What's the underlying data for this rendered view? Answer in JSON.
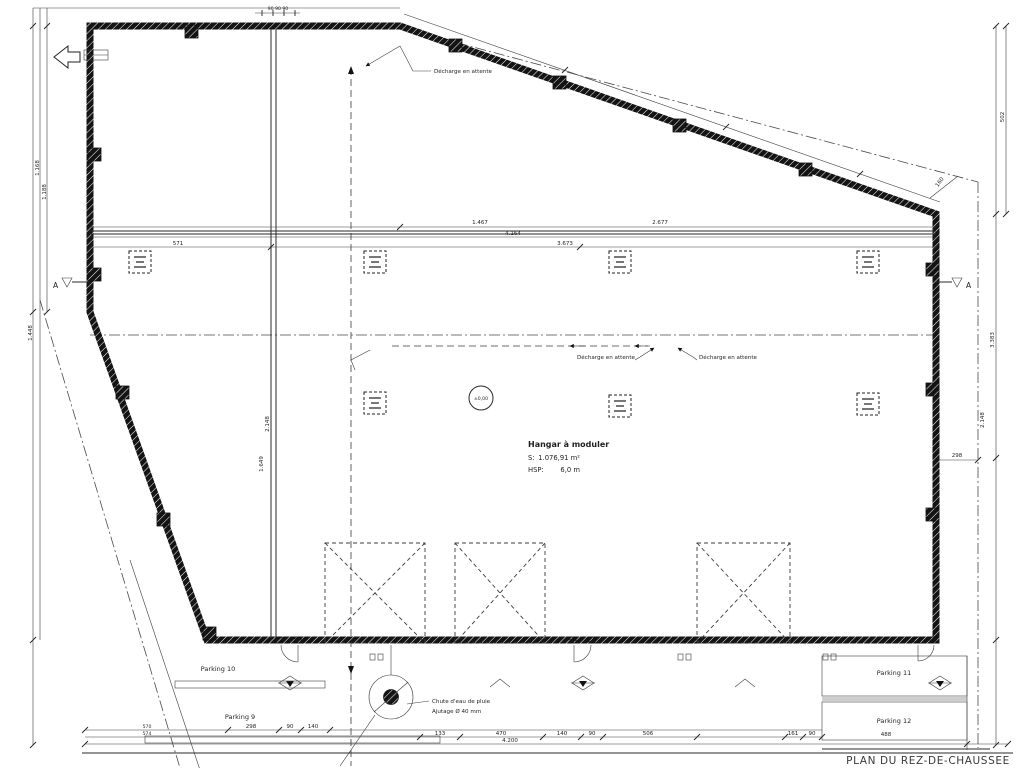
{
  "meta": {
    "drawing_title": "PLAN DU REZ-DE-CHAUSSEE"
  },
  "colors": {
    "ink": "#1a1a1a",
    "paper": "#ffffff"
  },
  "room": {
    "name": "Hangar à moduler",
    "surface_label": "S:",
    "surface_value": "1.076,91 m²",
    "height_label": "HSP:",
    "height_value": "6,0 m",
    "level_marker": "±0,00"
  },
  "labels": {
    "discharge_top": "Décharge en attente",
    "discharge_mid_left": "Décharge en attente",
    "discharge_mid_right": "Décharge en attente",
    "rainwater_line1": "Chute d'eau de pluie",
    "rainwater_line2": "Ajutage Ø 40 mm",
    "section_left": "A",
    "section_right": "A"
  },
  "parking": {
    "p9": "Parking 9",
    "p10": "Parking 10",
    "p11": "Parking 11",
    "p12": "Parking 12"
  },
  "dimensions": {
    "top_band_1a": "1.467",
    "top_band_1b": "2.677",
    "top_band_2": "4.164",
    "top_band_3a": "571",
    "top_band_3b": "3.673",
    "top_small": "90  90  90",
    "left_1": "1.168",
    "left_2": "1.188",
    "left_3": "1.448",
    "inner_left_1": "2.148",
    "inner_left_2": "1.649",
    "right_1": "502",
    "right_2": "3.383",
    "right_3": "2.148",
    "right_4": "298",
    "right_5": "160",
    "bottom_left_upper": "570",
    "bottom_left_lower": "574",
    "bottom_1": "298",
    "bottom_2": "90",
    "bottom_3": "140",
    "bottom_4": "133",
    "bottom_5": "470",
    "bottom_6": "140",
    "bottom_7": "90",
    "bottom_8": "506",
    "bottom_9": "161",
    "bottom_10": "90",
    "bottom_11": "488",
    "bottom_total": "4.200"
  }
}
